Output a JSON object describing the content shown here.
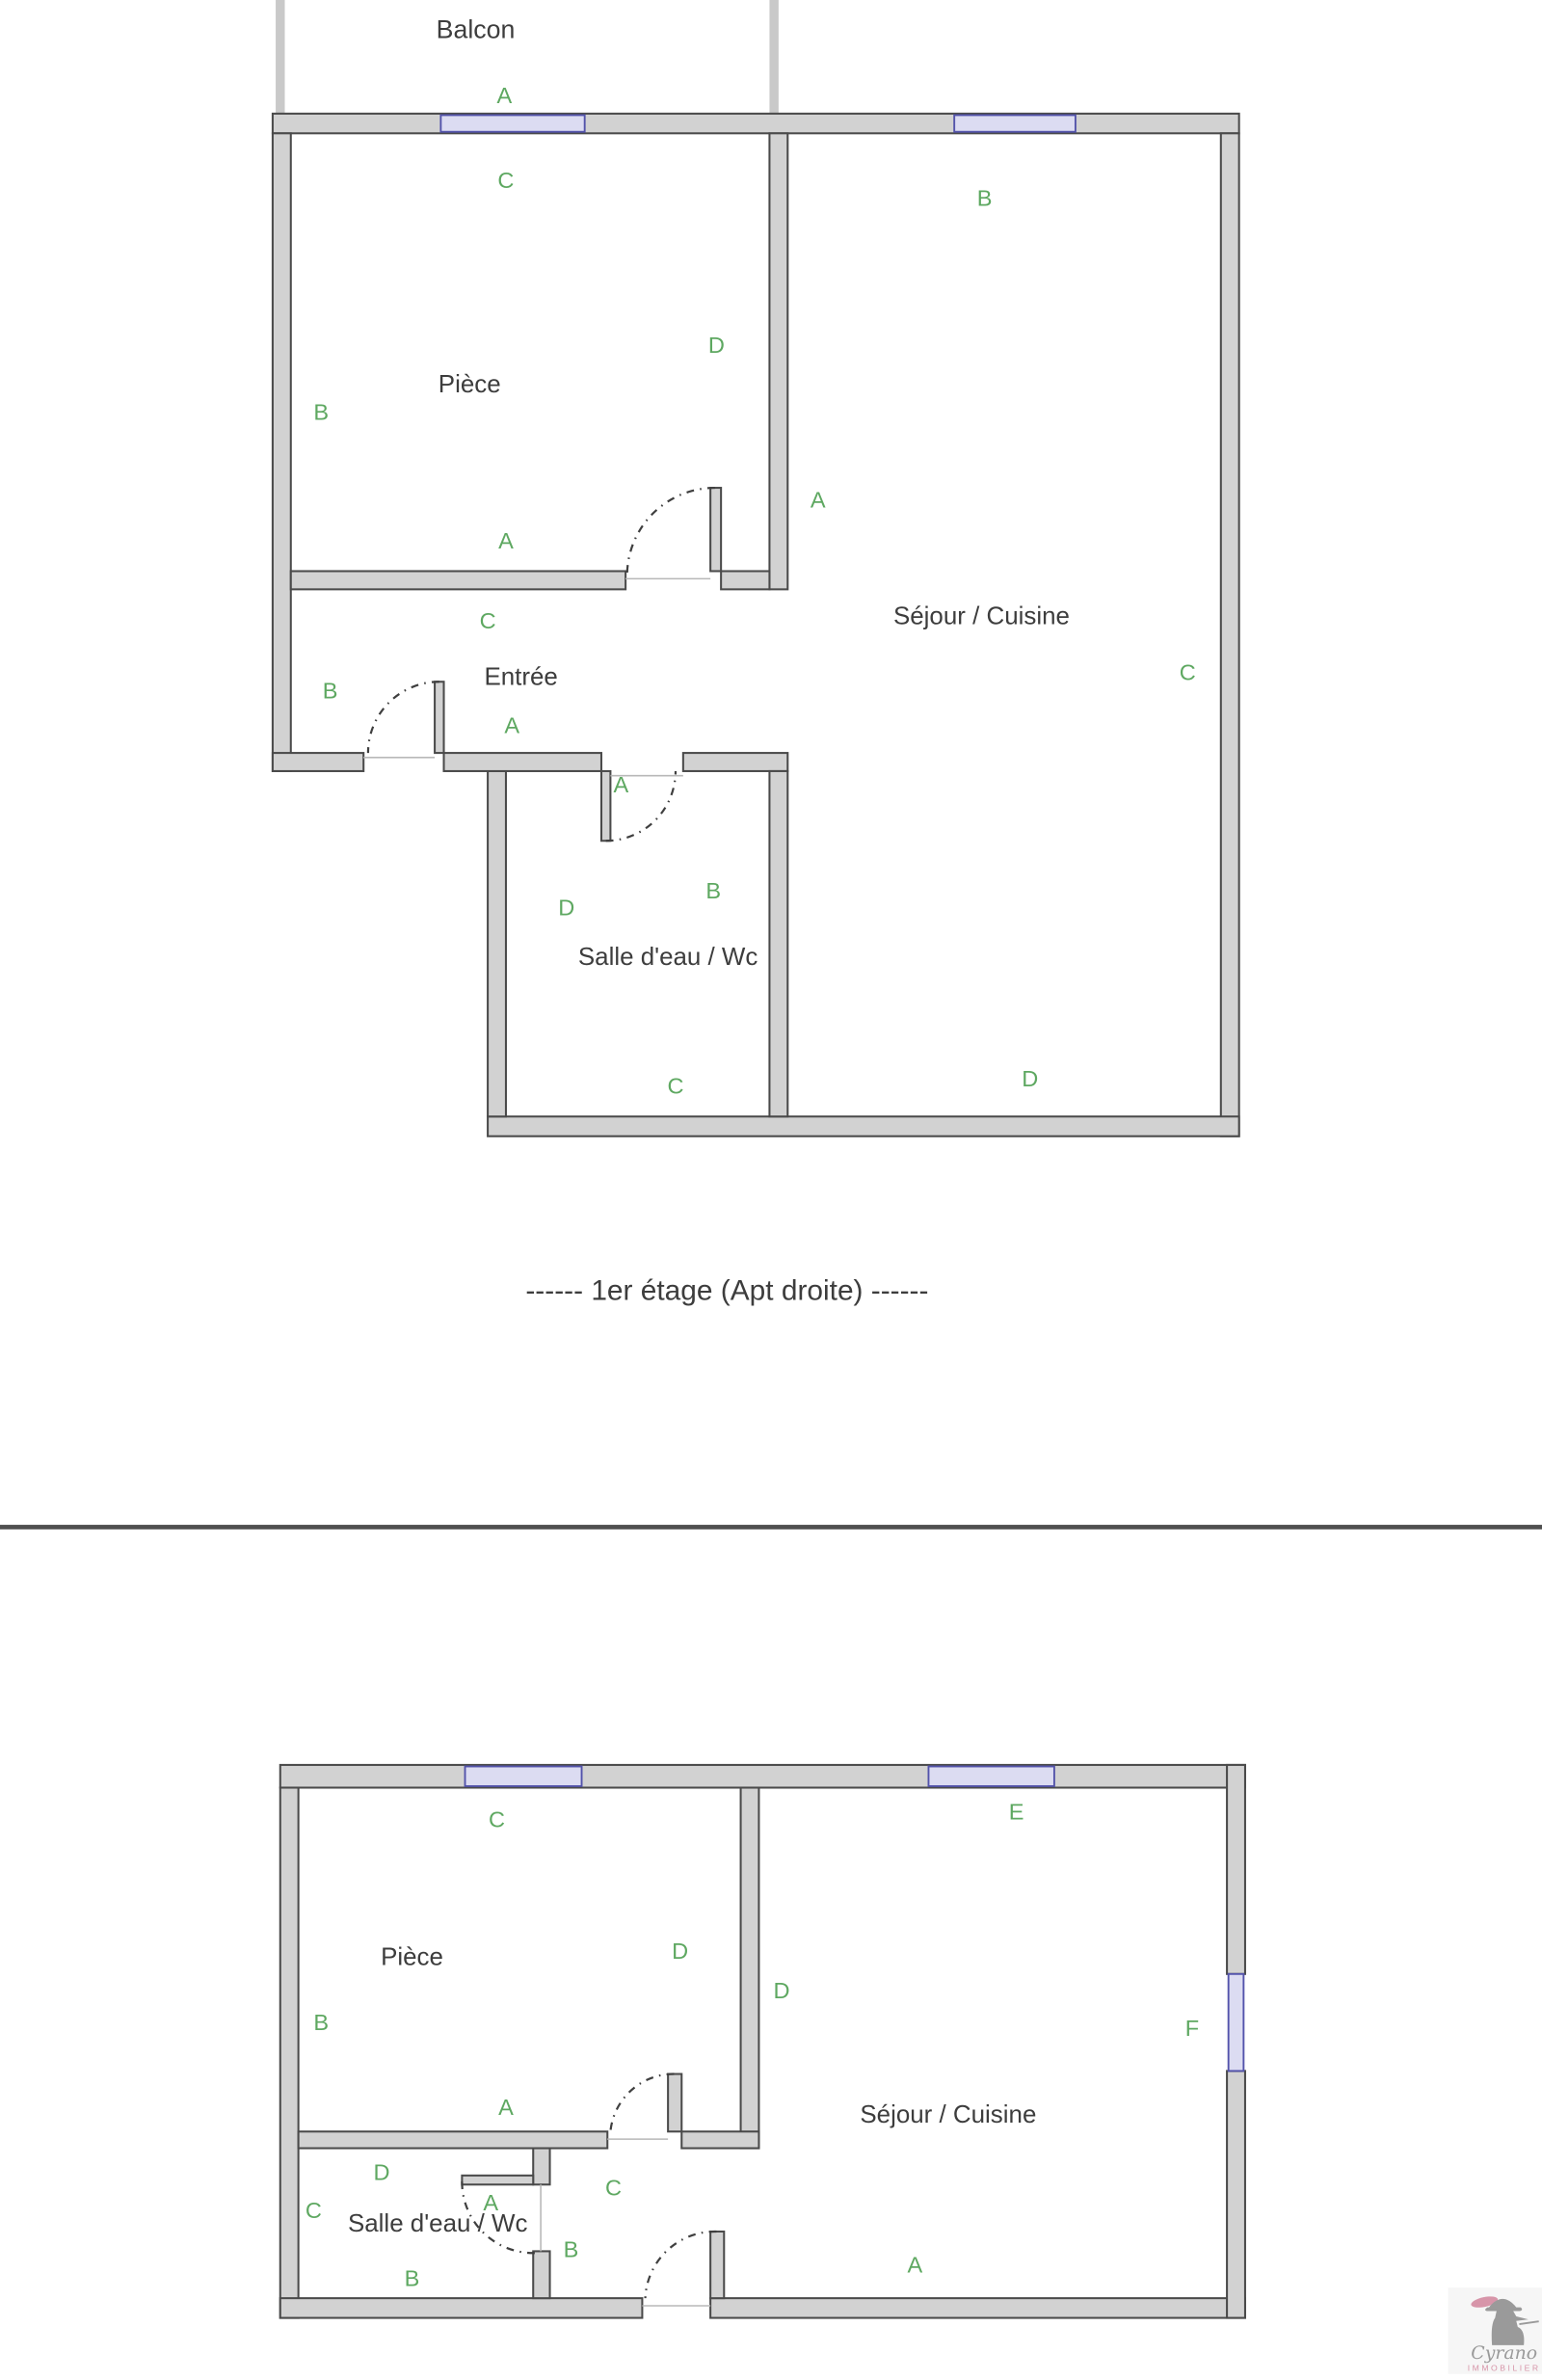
{
  "colors": {
    "wall_fill": "#d2d2d2",
    "wall_edge": "#4a4a4a",
    "window_fill": "#dcdcf2",
    "window_edge": "#5353ab",
    "label_green": "#5ea861",
    "room_text": "#3d3d3d",
    "balcony_gray": "#c9c9c9",
    "separator": "#4f4f4f",
    "thin_line": "#b8b8b8",
    "door_arc": "#3f3f3f",
    "watermark_gray": "#9a9a9a",
    "watermark_pink": "#d795a9"
  },
  "plan1": {
    "balcony_label": "Balcon",
    "rooms": [
      {
        "name": "Pièce"
      },
      {
        "name": "Séjour / Cuisine"
      },
      {
        "name": "Entrée"
      },
      {
        "name": "Salle d'eau / Wc"
      }
    ],
    "labels": [
      "A",
      "C",
      "B",
      "B",
      "D",
      "A",
      "A",
      "C",
      "B",
      "A",
      "A",
      "C",
      "D",
      "B",
      "C",
      "D"
    ]
  },
  "caption": {
    "text": "------   1er étage (Apt droite)   ------"
  },
  "plan2": {
    "rooms": [
      {
        "name": "Pièce"
      },
      {
        "name": "Séjour / Cuisine"
      },
      {
        "name": "Salle d'eau / Wc"
      }
    ],
    "labels": [
      "C",
      "E",
      "D",
      "D",
      "B",
      "F",
      "A",
      "D",
      "C",
      "C",
      "A",
      "B",
      "B",
      "A"
    ]
  },
  "watermark": {
    "brand": "Cyrano",
    "subtitle": "IMMOBILIER"
  }
}
